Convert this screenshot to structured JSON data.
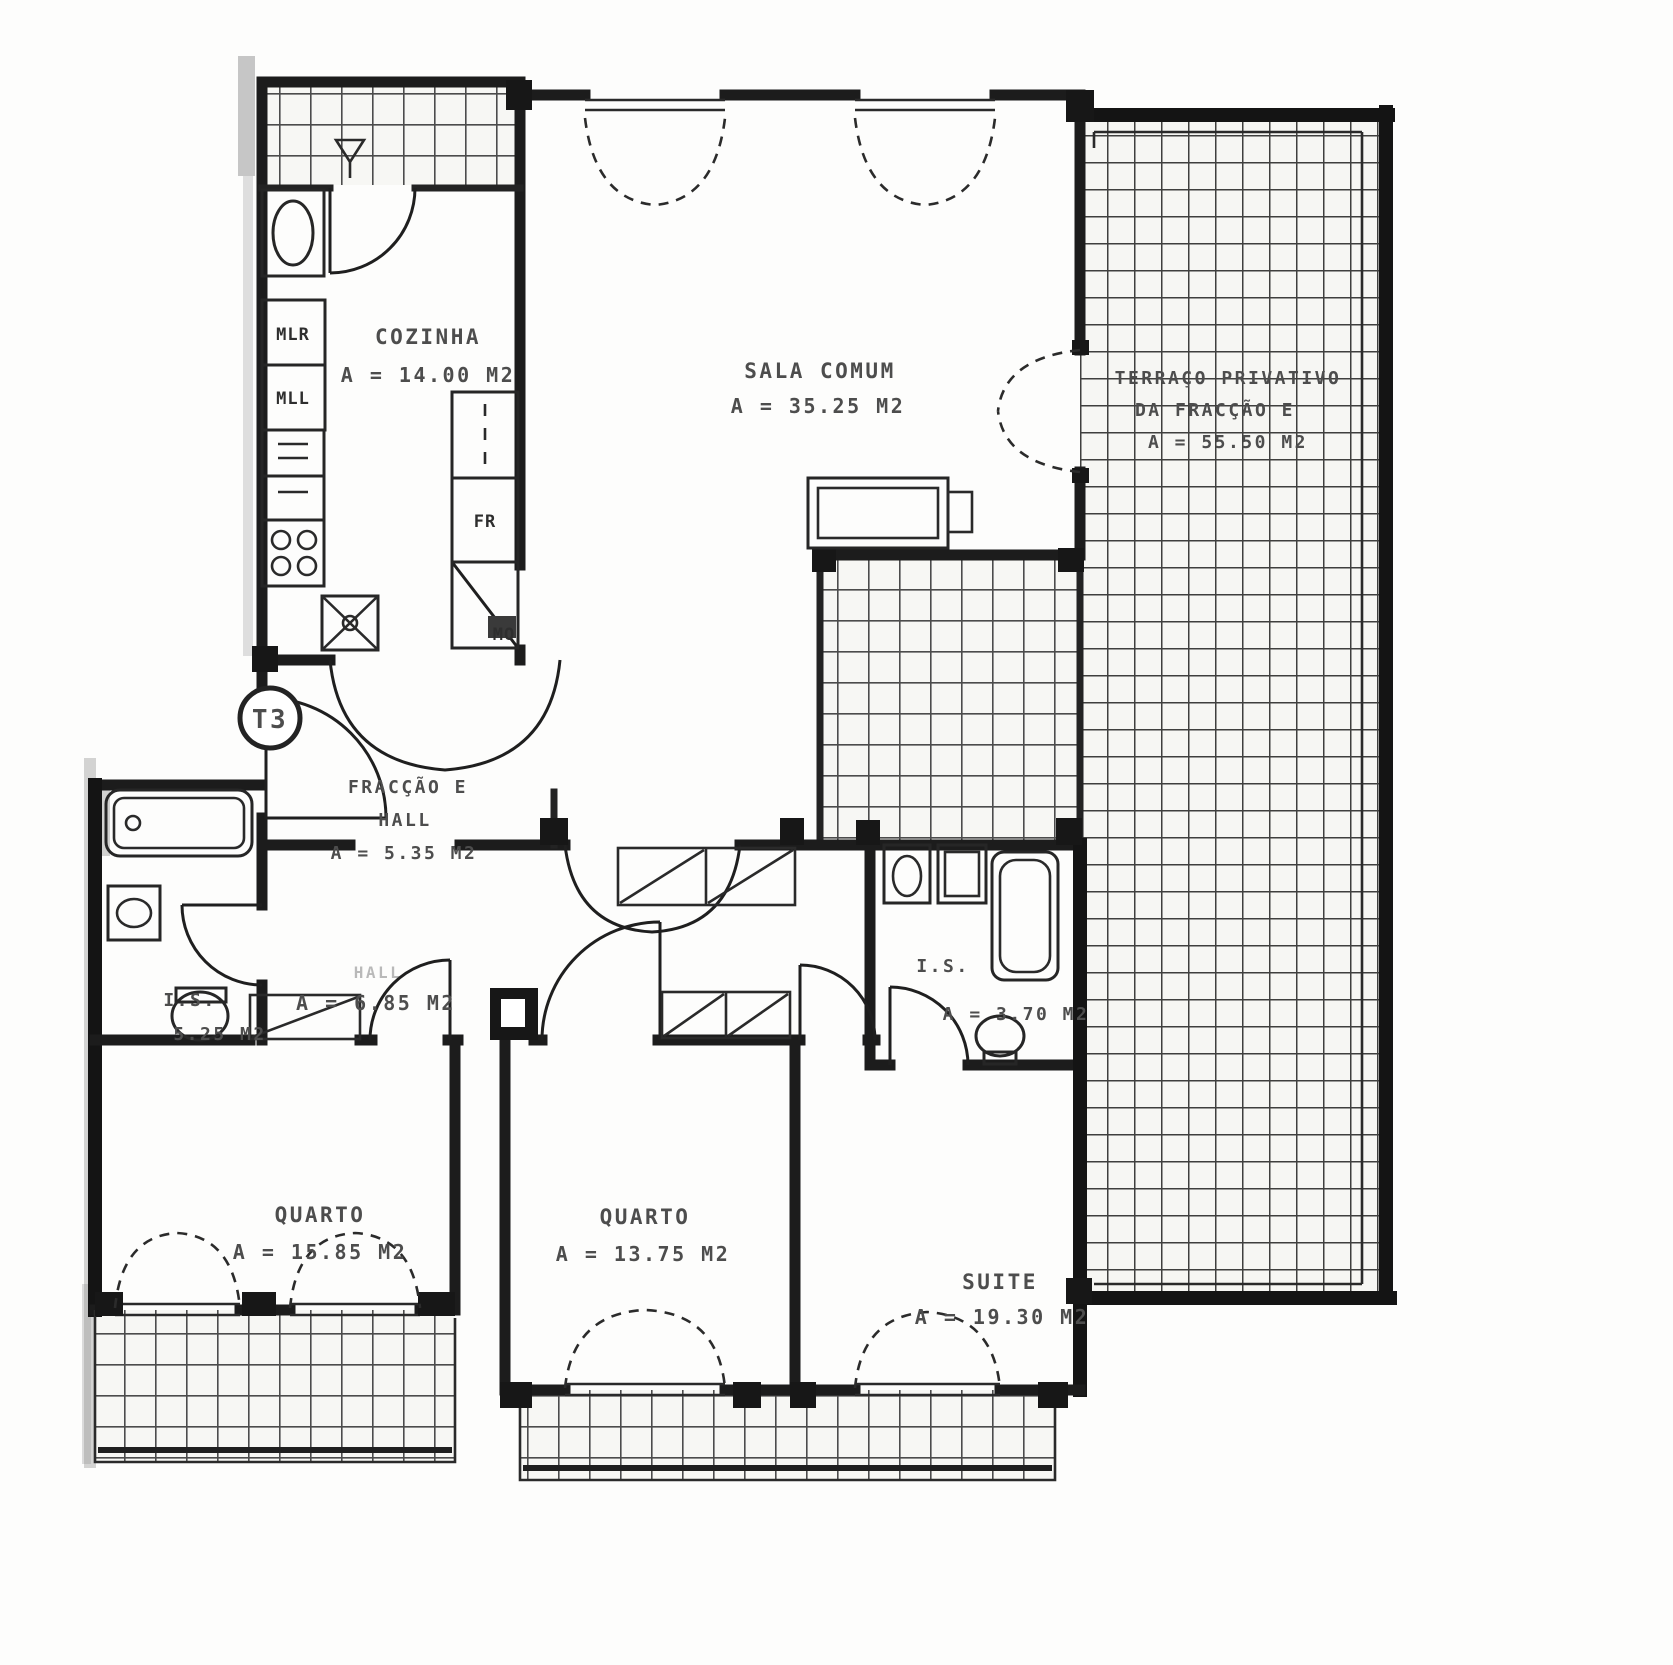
{
  "plan": {
    "badge": "T3",
    "rooms": {
      "cozinha": {
        "name": "COZINHA",
        "area": "A = 14.00 M2"
      },
      "sala": {
        "name": "SALA COMUM",
        "area": "A = 35.25 M2"
      },
      "terraco": {
        "line1": "TERRAÇO PRIVATIVO",
        "line2": "DA FRACÇÃO E",
        "area": "A = 55.50 M2"
      },
      "hall_entrada": {
        "line1": "FRACÇÃO E",
        "line2": "HALL",
        "area": "A = 5.35 M2"
      },
      "hall": {
        "name": "HALL",
        "area": "A = 6.85 M2"
      },
      "is_esq": {
        "name": "I.S.",
        "area": "5.25 M2"
      },
      "is_dir": {
        "name": "I.S.",
        "area": "A = 3.70 M2"
      },
      "quarto_esq": {
        "name": "QUARTO",
        "area": "A = 15.85 M2"
      },
      "quarto_meio": {
        "name": "QUARTO",
        "area": "A = 13.75 M2"
      },
      "suite": {
        "name": "SUITE",
        "area": "A = 19.30 M2"
      }
    },
    "appliances": {
      "mlr": "MLR",
      "mll": "MLL",
      "fr": "FR",
      "mo": "MO"
    }
  },
  "colors": {
    "ink": "#1c1c1c",
    "label_gray": "#4d4d4d",
    "paper": "#ffffff"
  }
}
